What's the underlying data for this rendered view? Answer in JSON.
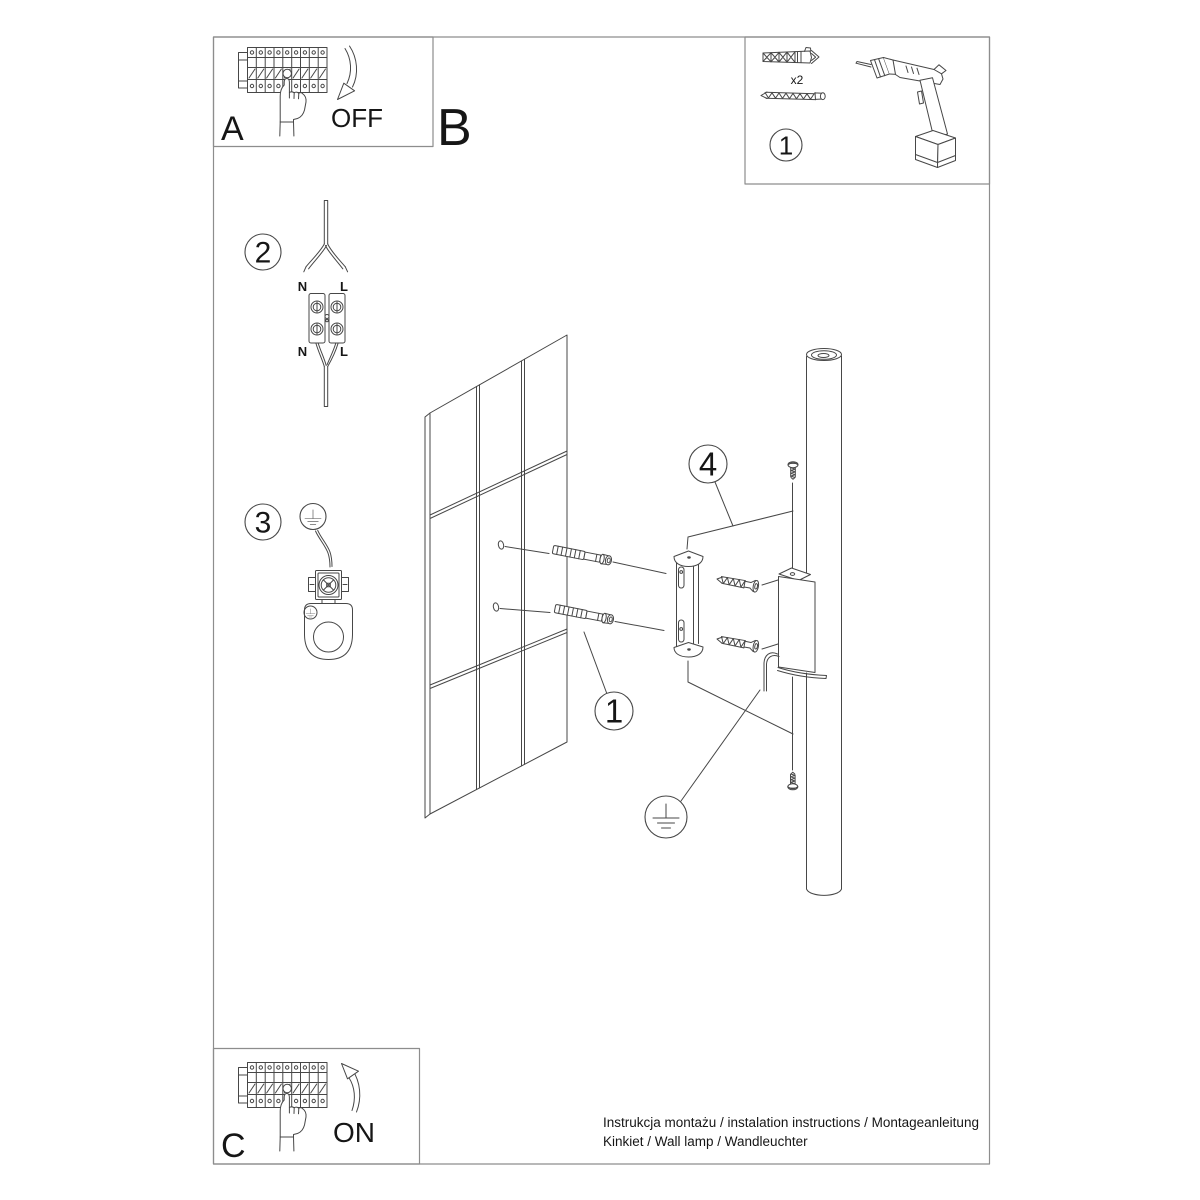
{
  "panel_a": {
    "letter": "A",
    "action": "OFF"
  },
  "panel_b": {
    "letter": "B"
  },
  "panel_c": {
    "letter": "C",
    "action": "ON"
  },
  "parts_box": {
    "number": "1",
    "anchor_count": "x2"
  },
  "step_wiring": {
    "number": "2",
    "label_n_top": "N",
    "label_l_top": "L",
    "label_n_bottom": "N",
    "label_l_bottom": "L"
  },
  "step_ground": {
    "number": "3"
  },
  "callout_anchor": {
    "number": "1"
  },
  "callout_mount": {
    "number": "4"
  },
  "footer": {
    "line1": "Instrukcja montażu / instalation instructions / Montageanleitung",
    "line2": "Kinkiet / Wall lamp / Wandleuchter"
  },
  "colors": {
    "line": "#474747",
    "border": "#8d8d8d",
    "text": "#161616",
    "background": "#ffffff"
  }
}
